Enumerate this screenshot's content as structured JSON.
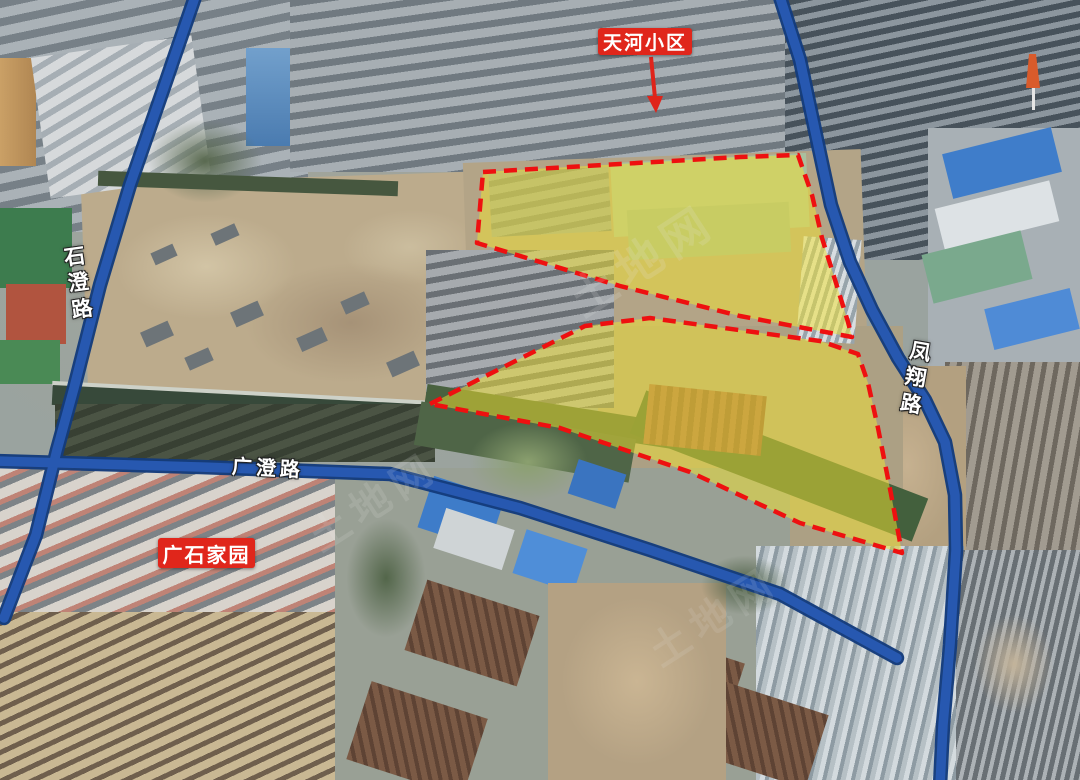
{
  "map": {
    "annotations": {
      "tianhe_label": "天河小区",
      "guangshi_label": "广石家园"
    },
    "roads": {
      "shicheng": "石澄路",
      "fengxiang": "凤翔路",
      "guangcheng": "广澄路"
    },
    "watermark": "土地网",
    "colors": {
      "parcel_fill": "#f3e430",
      "parcel_border": "#ee1010",
      "road_blue": "#2758b0",
      "label_box_red": "#e0261b",
      "label_text": "#ffffff"
    }
  }
}
